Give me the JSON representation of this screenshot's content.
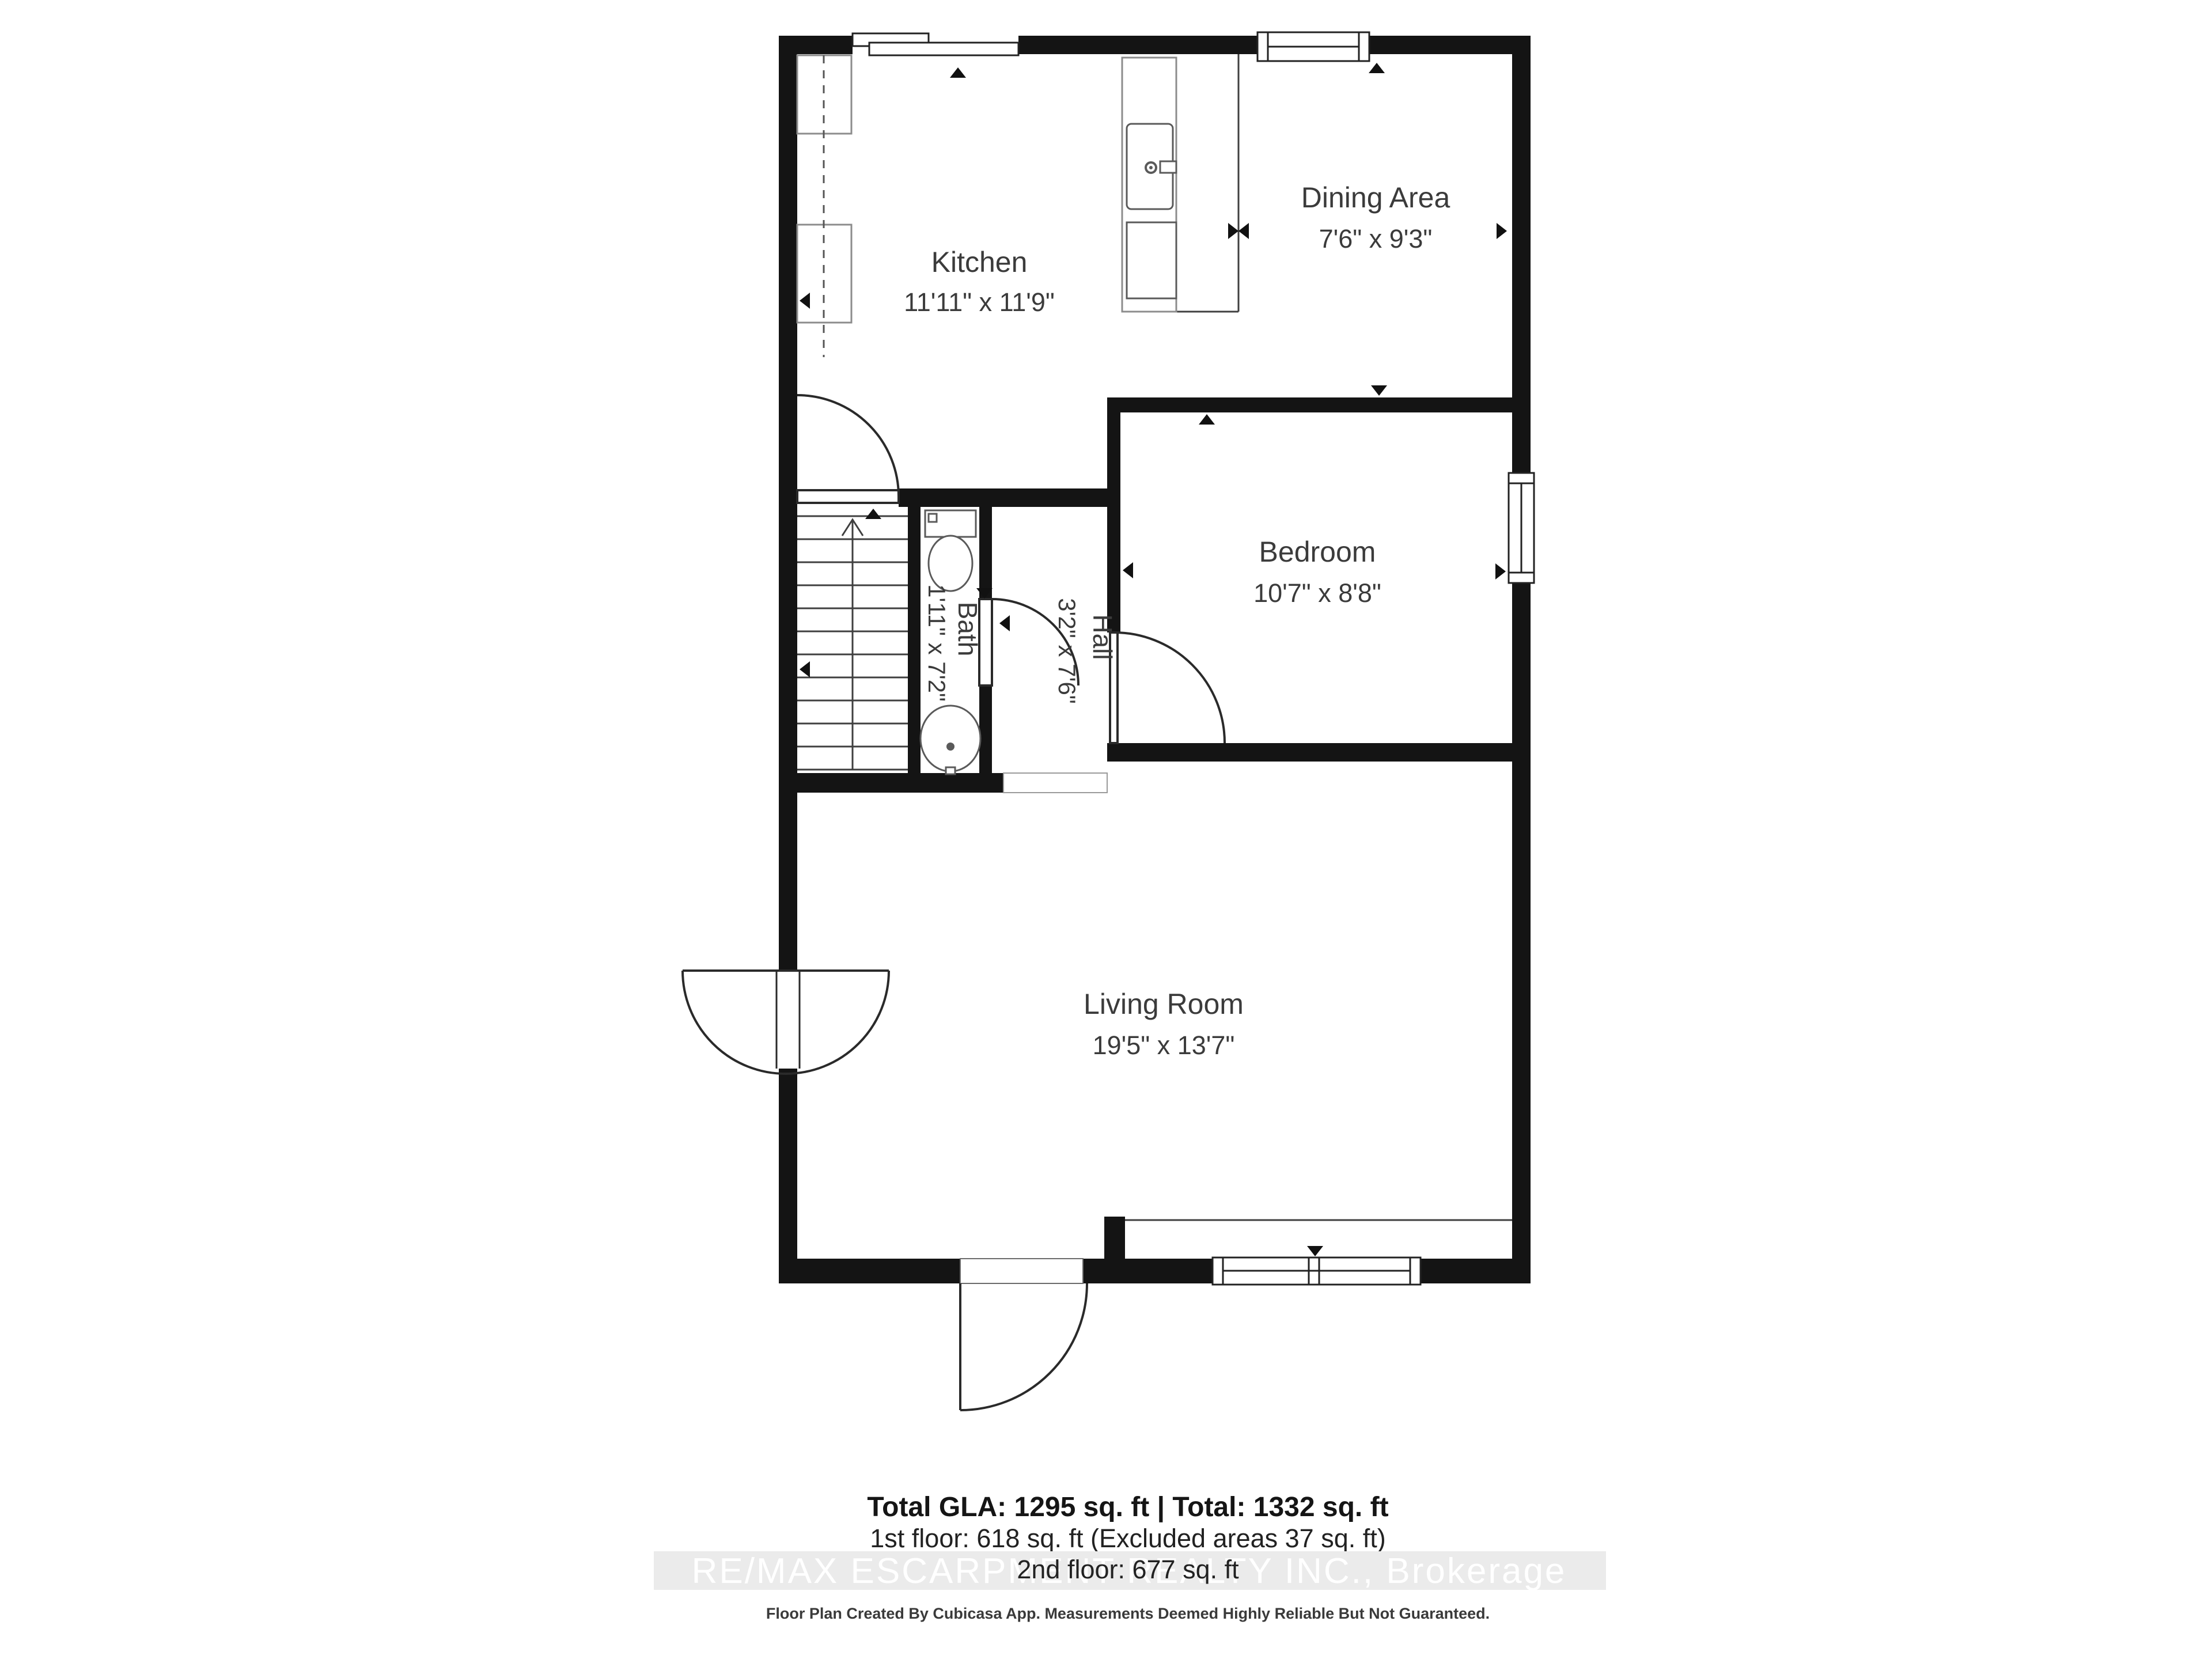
{
  "rooms": {
    "kitchen": {
      "name": "Kitchen",
      "dims": "11'11\" x 11'9\""
    },
    "dining": {
      "name": "Dining Area",
      "dims": "7'6\" x 9'3\""
    },
    "bedroom": {
      "name": "Bedroom",
      "dims": "10'7\" x 8'8\""
    },
    "bath": {
      "name": "Bath",
      "dims": "1'11\" x 7'2\""
    },
    "hall": {
      "name": "Hall",
      "dims": "3'2\" x 7'6\""
    },
    "living": {
      "name": "Living Room",
      "dims": "19'5\" x 13'7\""
    }
  },
  "summary": {
    "line1": "Total GLA: 1295 sq. ft | Total: 1332 sq. ft",
    "line2": "1st floor: 618 sq. ft (Excluded areas 37 sq. ft)",
    "line3": "2nd floor: 677 sq. ft"
  },
  "watermark": "RE/MAX ESCARPMENT REALTY INC., Brokerage",
  "footer": "Floor Plan Created By Cubicasa App. Measurements Deemed Highly Reliable But Not Guaranteed.",
  "colors": {
    "wall": "#141414",
    "text": "#3b3b3b",
    "watermark_band": "#ebebeb",
    "watermark_text": "#ffffff"
  }
}
